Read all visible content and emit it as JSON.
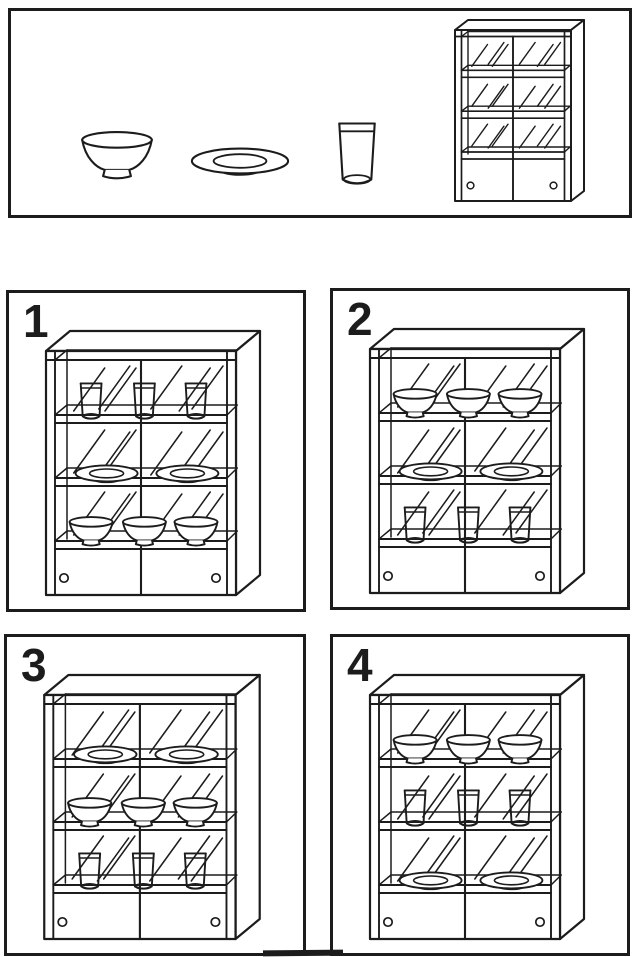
{
  "colors": {
    "ink": "#1c1c1c",
    "paper": "#ffffff"
  },
  "panels": {
    "reference": {
      "items": [
        {
          "type": "bowl"
        },
        {
          "type": "plate"
        },
        {
          "type": "glass"
        },
        {
          "type": "cabinet"
        }
      ]
    },
    "options": [
      {
        "number": "1",
        "shelves": [
          {
            "item": "glass",
            "count": 3
          },
          {
            "item": "plate",
            "count": 2
          },
          {
            "item": "bowl",
            "count": 3
          }
        ]
      },
      {
        "number": "2",
        "shelves": [
          {
            "item": "bowl",
            "count": 3
          },
          {
            "item": "plate",
            "count": 2
          },
          {
            "item": "glass",
            "count": 3
          }
        ]
      },
      {
        "number": "3",
        "shelves": [
          {
            "item": "plate",
            "count": 2
          },
          {
            "item": "bowl",
            "count": 3
          },
          {
            "item": "glass",
            "count": 3
          }
        ]
      },
      {
        "number": "4",
        "shelves": [
          {
            "item": "bowl",
            "count": 3
          },
          {
            "item": "glass",
            "count": 3
          },
          {
            "item": "plate",
            "count": 2
          }
        ]
      }
    ]
  }
}
